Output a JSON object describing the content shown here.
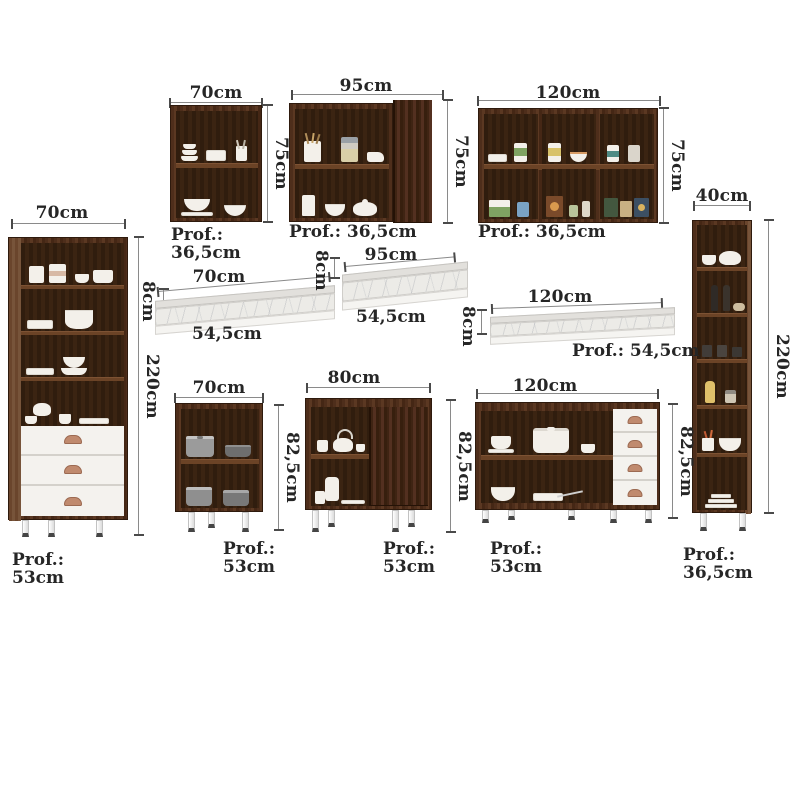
{
  "title": "Kitchen cabinet set dimensions diagram",
  "colors": {
    "wood": "#4f2f1d",
    "wood_interior": "#331f10",
    "white_front": "#f4f2ee",
    "handle_copper": "#c08a6e",
    "marble": "#ecebe7",
    "dimension_text": "#262626",
    "dimension_line": "#8a8a8a"
  },
  "pieces": [
    {
      "id": "wall-cabinet-70",
      "w": "70cm",
      "h": "75cm",
      "d1": "Prof.:",
      "d2": "36,5cm"
    },
    {
      "id": "wall-cabinet-95",
      "w": "95cm",
      "h": "75cm",
      "d1": "Prof.: 36,5cm",
      "d2": ""
    },
    {
      "id": "wall-cabinet-120",
      "w": "120cm",
      "h": "75cm",
      "d1": "Prof.: 36,5cm",
      "d2": ""
    },
    {
      "id": "tall-cabinet-70",
      "w": "70cm",
      "h": "220cm",
      "d1": "Prof.:",
      "d2": "53cm"
    },
    {
      "id": "tall-cabinet-40",
      "w": "40cm",
      "h": "220cm",
      "d1": "Prof.:",
      "d2": "36,5cm"
    },
    {
      "id": "countertop-70",
      "w": "70cm",
      "h": "8cm",
      "d1": "54,5cm",
      "d2": ""
    },
    {
      "id": "countertop-95",
      "w": "95cm",
      "h": "8cm",
      "d1": "54,5cm",
      "d2": ""
    },
    {
      "id": "countertop-120",
      "w": "120cm",
      "h": "8cm",
      "d1": "Prof.: 54,5cm",
      "d2": ""
    },
    {
      "id": "base-cabinet-70",
      "w": "70cm",
      "h": "82,5cm",
      "d1": "Prof.:",
      "d2": "53cm"
    },
    {
      "id": "base-cabinet-80",
      "w": "80cm",
      "h": "82,5cm",
      "d1": "Prof.:",
      "d2": "53cm"
    },
    {
      "id": "base-cabinet-120",
      "w": "120cm",
      "h": "82,5cm",
      "d1": "Prof.:",
      "d2": "53cm"
    }
  ]
}
